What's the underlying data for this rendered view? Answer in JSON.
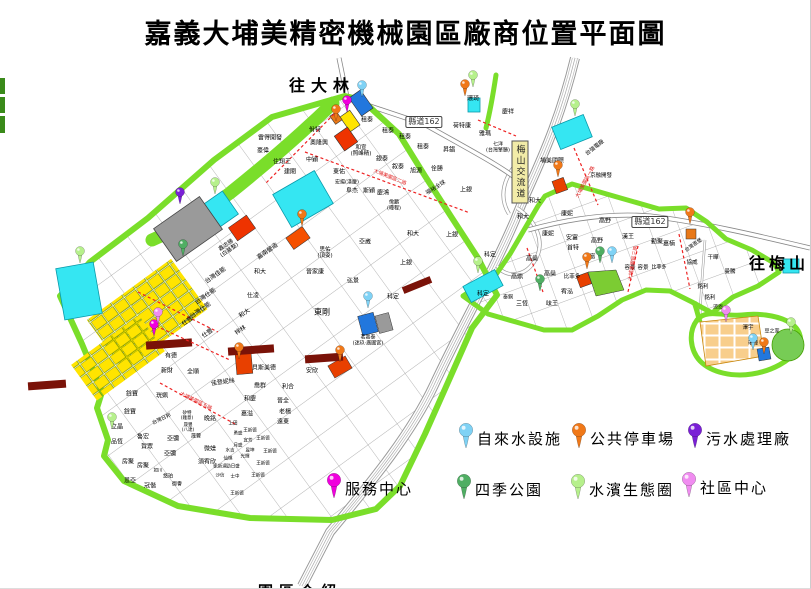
{
  "title": "嘉義大埔美精密機械園區廠商位置平面圖",
  "directions": {
    "to_dalin": {
      "t": "往大林",
      "x": 322,
      "y": 84
    },
    "to_meishan": {
      "t": "往梅山",
      "x": 779,
      "y": 262
    },
    "bottom_partial": {
      "t": "園區介紹",
      "x": 300,
      "y": 591
    }
  },
  "road_badges": [
    {
      "label": "縣道162",
      "x": 424,
      "y": 122
    },
    {
      "label": "縣道162",
      "x": 650,
      "y": 222
    }
  ],
  "interchange": {
    "label": "梅山交流道",
    "x": 520,
    "y": 172
  },
  "road_names": [
    {
      "t": "大埔美園區二路",
      "x": 390,
      "y": 177,
      "r": 22
    },
    {
      "t": "大埔美園區一路",
      "x": 585,
      "y": 182,
      "r": -62
    },
    {
      "t": "大埔美園區三路",
      "x": 633,
      "y": 263,
      "r": -80
    },
    {
      "t": "大埔美園區五路",
      "x": 196,
      "y": 401,
      "r": 26
    }
  ],
  "pin_colors": {
    "waterworks": "#7fd2f5",
    "parking": "#f07818",
    "sewage": "#7a1fd6",
    "service": "#f000dd",
    "park": "#4fae63",
    "eco": "#b6f08c",
    "community": "#f08cf0"
  },
  "legend": {
    "items": [
      {
        "label": "自來水設施",
        "type": "waterworks",
        "x": 466,
        "y": 448
      },
      {
        "label": "公共停車場",
        "type": "parking",
        "x": 579,
        "y": 448
      },
      {
        "label": "污水處理廠",
        "type": "sewage",
        "x": 695,
        "y": 448
      },
      {
        "label": "服務中心",
        "type": "service",
        "x": 334,
        "y": 498
      },
      {
        "label": "四季公園",
        "type": "park",
        "x": 464,
        "y": 499
      },
      {
        "label": "水濱生態圈",
        "type": "eco",
        "x": 578,
        "y": 499
      },
      {
        "label": "社區中心",
        "type": "community",
        "x": 689,
        "y": 497
      }
    ]
  },
  "pins": [
    {
      "type": "waterworks",
      "x": 362,
      "y": 97
    },
    {
      "type": "waterworks",
      "x": 368,
      "y": 308
    },
    {
      "type": "waterworks",
      "x": 612,
      "y": 263
    },
    {
      "type": "waterworks",
      "x": 753,
      "y": 350
    },
    {
      "type": "parking",
      "x": 336,
      "y": 121
    },
    {
      "type": "parking",
      "x": 465,
      "y": 96
    },
    {
      "type": "parking",
      "x": 302,
      "y": 226
    },
    {
      "type": "parking",
      "x": 239,
      "y": 359
    },
    {
      "type": "parking",
      "x": 340,
      "y": 362
    },
    {
      "type": "parking",
      "x": 558,
      "y": 177
    },
    {
      "type": "parking",
      "x": 587,
      "y": 269
    },
    {
      "type": "parking",
      "x": 690,
      "y": 224
    },
    {
      "type": "parking",
      "x": 764,
      "y": 354
    },
    {
      "type": "sewage",
      "x": 180,
      "y": 204
    },
    {
      "type": "service",
      "x": 347,
      "y": 112
    },
    {
      "type": "service",
      "x": 154,
      "y": 336
    },
    {
      "type": "park",
      "x": 183,
      "y": 256
    },
    {
      "type": "park",
      "x": 600,
      "y": 263
    },
    {
      "type": "park",
      "x": 540,
      "y": 291
    },
    {
      "type": "eco",
      "x": 80,
      "y": 263
    },
    {
      "type": "eco",
      "x": 215,
      "y": 194
    },
    {
      "type": "eco",
      "x": 112,
      "y": 429
    },
    {
      "type": "eco",
      "x": 473,
      "y": 87
    },
    {
      "type": "eco",
      "x": 575,
      "y": 116
    },
    {
      "type": "eco",
      "x": 478,
      "y": 273
    },
    {
      "type": "eco",
      "x": 791,
      "y": 334
    },
    {
      "type": "community",
      "x": 158,
      "y": 324
    },
    {
      "type": "community",
      "x": 726,
      "y": 322
    }
  ],
  "plots": [
    {
      "t": "雷得開發",
      "x": 270,
      "y": 139
    },
    {
      "t": "豪偉",
      "x": 263,
      "y": 152
    },
    {
      "t": "住翔王",
      "x": 282,
      "y": 163
    },
    {
      "t": "建閎",
      "x": 290,
      "y": 173
    },
    {
      "t": "佾特",
      "x": 315,
      "y": 131
    },
    {
      "t": "奧隆興",
      "x": 319,
      "y": 144
    },
    {
      "t": "中穎",
      "x": 312,
      "y": 161
    },
    {
      "t": "和宣\n(照峰精)",
      "x": 361,
      "y": 151,
      "s": 5.5
    },
    {
      "t": "東佑",
      "x": 339,
      "y": 173
    },
    {
      "t": "宏揚(漢慶)",
      "x": 347,
      "y": 183,
      "s": 5
    },
    {
      "t": "阜杰",
      "x": 352,
      "y": 192
    },
    {
      "t": "斯穎",
      "x": 369,
      "y": 192
    },
    {
      "t": "慶鴻",
      "x": 383,
      "y": 194
    },
    {
      "t": "佾鵬\n(曄程)",
      "x": 394,
      "y": 206,
      "s": 5
    },
    {
      "t": "租泰",
      "x": 367,
      "y": 121
    },
    {
      "t": "租泰",
      "x": 388,
      "y": 132
    },
    {
      "t": "租泰",
      "x": 405,
      "y": 138
    },
    {
      "t": "租泰",
      "x": 423,
      "y": 148
    },
    {
      "t": "銀泰",
      "x": 382,
      "y": 160
    },
    {
      "t": "叙泰",
      "x": 398,
      "y": 168
    },
    {
      "t": "旭源",
      "x": 416,
      "y": 172
    },
    {
      "t": "佺勝",
      "x": 437,
      "y": 170
    },
    {
      "t": "昇錩",
      "x": 449,
      "y": 151
    },
    {
      "t": "福裕全球",
      "x": 436,
      "y": 188,
      "r": -32,
      "s": 5.5
    },
    {
      "t": "上銀",
      "x": 466,
      "y": 191
    },
    {
      "t": "環琦",
      "x": 473,
      "y": 100
    },
    {
      "t": "慶祥",
      "x": 508,
      "y": 113
    },
    {
      "t": "荷特康",
      "x": 462,
      "y": 127
    },
    {
      "t": "雅瑪",
      "x": 485,
      "y": 135
    },
    {
      "t": "七洋\n(台灣擎勝)",
      "x": 498,
      "y": 148,
      "s": 5
    },
    {
      "t": "埔美國際",
      "x": 552,
      "y": 162
    },
    {
      "t": "台強電廠",
      "x": 595,
      "y": 148,
      "r": -38,
      "s": 5.5
    },
    {
      "t": "京融開發",
      "x": 601,
      "y": 176,
      "s": 5.5
    },
    {
      "t": "鑫志勝\n(白基整)",
      "x": 228,
      "y": 248,
      "r": -35,
      "s": 5.5
    },
    {
      "t": "台灣佳能",
      "x": 216,
      "y": 276,
      "r": -35
    },
    {
      "t": "台灣仕能",
      "x": 206,
      "y": 297,
      "r": -35
    },
    {
      "t": "台灣仕能",
      "x": 201,
      "y": 311,
      "r": -35
    },
    {
      "t": "仕豐",
      "x": 188,
      "y": 322,
      "r": -35
    },
    {
      "t": "仕豐",
      "x": 208,
      "y": 334,
      "r": -35
    },
    {
      "t": "和大",
      "x": 245,
      "y": 314,
      "r": -35
    },
    {
      "t": "梓林",
      "x": 241,
      "y": 331,
      "r": -35
    },
    {
      "t": "嘉南營造",
      "x": 268,
      "y": 252,
      "r": -35
    },
    {
      "t": "和大",
      "x": 260,
      "y": 273
    },
    {
      "t": "仕凌",
      "x": 253,
      "y": 297
    },
    {
      "t": "思佑\n(頂姿)",
      "x": 325,
      "y": 253,
      "s": 5.5
    },
    {
      "t": "晉家康",
      "x": 315,
      "y": 273
    },
    {
      "t": "弘景",
      "x": 353,
      "y": 282
    },
    {
      "t": "亞崴",
      "x": 365,
      "y": 243
    },
    {
      "t": "上銀",
      "x": 452,
      "y": 236
    },
    {
      "t": "上銀",
      "x": 406,
      "y": 264
    },
    {
      "t": "和大",
      "x": 413,
      "y": 235
    },
    {
      "t": "科定",
      "x": 393,
      "y": 298
    },
    {
      "t": "東剛",
      "x": 322,
      "y": 313,
      "s": 8
    },
    {
      "t": "茗嘉泰\n(迷玖·廣圃宮)",
      "x": 368,
      "y": 341,
      "s": 5
    },
    {
      "t": "貝斯美德",
      "x": 264,
      "y": 369
    },
    {
      "t": "安欣",
      "x": 312,
      "y": 372
    },
    {
      "t": "有德",
      "x": 171,
      "y": 357
    },
    {
      "t": "新財",
      "x": 167,
      "y": 372
    },
    {
      "t": "全順",
      "x": 193,
      "y": 373
    },
    {
      "t": "佳登妮絲",
      "x": 223,
      "y": 383,
      "r": -8
    },
    {
      "t": "喬群",
      "x": 260,
      "y": 387
    },
    {
      "t": "利合",
      "x": 288,
      "y": 388
    },
    {
      "t": "和慶",
      "x": 250,
      "y": 400
    },
    {
      "t": "晉全",
      "x": 283,
      "y": 402
    },
    {
      "t": "嘉溢",
      "x": 247,
      "y": 415
    },
    {
      "t": "老楊",
      "x": 285,
      "y": 413
    },
    {
      "t": "遠東",
      "x": 283,
      "y": 423
    },
    {
      "t": "銓寶",
      "x": 132,
      "y": 395
    },
    {
      "t": "銓寶",
      "x": 130,
      "y": 413
    },
    {
      "t": "珖姵",
      "x": 162,
      "y": 397
    },
    {
      "t": "台灣日邦",
      "x": 162,
      "y": 420,
      "r": -25,
      "s": 5
    },
    {
      "t": "矽特\n(雞意)",
      "x": 187,
      "y": 417,
      "s": 4.5
    },
    {
      "t": "晚銘",
      "x": 210,
      "y": 420
    },
    {
      "t": "立晶",
      "x": 117,
      "y": 428
    },
    {
      "t": "晟豐\n(八達)",
      "x": 188,
      "y": 429,
      "s": 4.5
    },
    {
      "t": "晟豐",
      "x": 196,
      "y": 437,
      "s": 5
    },
    {
      "t": "品恆",
      "x": 117,
      "y": 443
    },
    {
      "t": "魯宏",
      "x": 143,
      "y": 438
    },
    {
      "t": "賀眾",
      "x": 147,
      "y": 448
    },
    {
      "t": "亞彌",
      "x": 173,
      "y": 440
    },
    {
      "t": "亞彌",
      "x": 170,
      "y": 455
    },
    {
      "t": "微媄",
      "x": 210,
      "y": 450
    },
    {
      "t": "房聚",
      "x": 128,
      "y": 463
    },
    {
      "t": "房聚",
      "x": 143,
      "y": 467
    },
    {
      "t": "須宥欣",
      "x": 207,
      "y": 463
    },
    {
      "t": "如川",
      "x": 158,
      "y": 472,
      "s": 4.5
    },
    {
      "t": "悠珀",
      "x": 168,
      "y": 477,
      "s": 5
    },
    {
      "t": "恩亞",
      "x": 130,
      "y": 482
    },
    {
      "t": "冠偕",
      "x": 150,
      "y": 487
    },
    {
      "t": "御譽",
      "x": 177,
      "y": 485,
      "s": 5
    },
    {
      "t": "上田",
      "x": 233,
      "y": 425,
      "s": 4.5
    },
    {
      "t": "勇盛",
      "x": 238,
      "y": 435,
      "s": 4.5
    },
    {
      "t": "王新德",
      "x": 250,
      "y": 432,
      "s": 4.5
    },
    {
      "t": "宜芳",
      "x": 248,
      "y": 442,
      "s": 4.5
    },
    {
      "t": "月盛",
      "x": 238,
      "y": 447,
      "s": 4.5
    },
    {
      "t": "昱坤",
      "x": 250,
      "y": 452,
      "s": 4.5
    },
    {
      "t": "水吉",
      "x": 230,
      "y": 452,
      "s": 4.5
    },
    {
      "t": "光輝",
      "x": 245,
      "y": 458,
      "s": 4.5
    },
    {
      "t": "仙棋",
      "x": 228,
      "y": 460,
      "s": 4.5
    },
    {
      "t": "勁日盛",
      "x": 233,
      "y": 468,
      "s": 4.5
    },
    {
      "t": "凱新達",
      "x": 220,
      "y": 468,
      "s": 4.5
    },
    {
      "t": "沙信",
      "x": 220,
      "y": 477,
      "s": 4.5
    },
    {
      "t": "士中",
      "x": 235,
      "y": 478,
      "s": 4.5
    },
    {
      "t": "王新德",
      "x": 263,
      "y": 440,
      "s": 4.5
    },
    {
      "t": "王新德",
      "x": 270,
      "y": 453,
      "s": 4.5
    },
    {
      "t": "王新德",
      "x": 263,
      "y": 465,
      "s": 4.5
    },
    {
      "t": "王新德",
      "x": 258,
      "y": 477,
      "s": 4.5
    },
    {
      "t": "王新德",
      "x": 237,
      "y": 495,
      "s": 4.5
    },
    {
      "t": "和大",
      "x": 535,
      "y": 202
    },
    {
      "t": "和大",
      "x": 523,
      "y": 218
    },
    {
      "t": "康妮",
      "x": 567,
      "y": 215
    },
    {
      "t": "康妮",
      "x": 548,
      "y": 235
    },
    {
      "t": "安富",
      "x": 572,
      "y": 239
    },
    {
      "t": "首特",
      "x": 573,
      "y": 249
    },
    {
      "t": "高野",
      "x": 605,
      "y": 222
    },
    {
      "t": "高野",
      "x": 597,
      "y": 242
    },
    {
      "t": "漢王",
      "x": 628,
      "y": 238
    },
    {
      "t": "勤聚",
      "x": 657,
      "y": 243
    },
    {
      "t": "嘉楠",
      "x": 669,
      "y": 245
    },
    {
      "t": "台灣恩堡",
      "x": 694,
      "y": 246,
      "r": -35,
      "s": 5
    },
    {
      "t": "容景",
      "x": 630,
      "y": 268,
      "s": 5.5
    },
    {
      "t": "容景",
      "x": 643,
      "y": 268,
      "s": 5.5
    },
    {
      "t": "比菲多",
      "x": 659,
      "y": 268,
      "s": 5
    },
    {
      "t": "比菲多",
      "x": 572,
      "y": 277,
      "s": 5.5
    },
    {
      "t": "協威",
      "x": 692,
      "y": 263,
      "s": 5.5
    },
    {
      "t": "干曄",
      "x": 713,
      "y": 258,
      "s": 5.5
    },
    {
      "t": "曼騰",
      "x": 730,
      "y": 272,
      "s": 5.5
    },
    {
      "t": "銘利",
      "x": 703,
      "y": 287,
      "s": 5.5
    },
    {
      "t": "銘利",
      "x": 710,
      "y": 298,
      "s": 5.5
    },
    {
      "t": "涼恩",
      "x": 718,
      "y": 308,
      "s": 5
    },
    {
      "t": "澤宇",
      "x": 748,
      "y": 328,
      "s": 5.5
    },
    {
      "t": "瑞曄",
      "x": 753,
      "y": 344,
      "s": 5
    },
    {
      "t": "豆之家",
      "x": 772,
      "y": 332,
      "s": 5
    },
    {
      "t": "高鼎",
      "x": 517,
      "y": 278
    },
    {
      "t": "高燊",
      "x": 532,
      "y": 260
    },
    {
      "t": "高燊",
      "x": 550,
      "y": 275
    },
    {
      "t": "旦富",
      "x": 590,
      "y": 257,
      "s": 5.5
    },
    {
      "t": "宥泓",
      "x": 567,
      "y": 293
    },
    {
      "t": "味王",
      "x": 552,
      "y": 305
    },
    {
      "t": "三恆",
      "x": 522,
      "y": 305
    },
    {
      "t": "泰銅",
      "x": 508,
      "y": 298,
      "s": 5
    },
    {
      "t": "科定",
      "x": 490,
      "y": 256
    },
    {
      "t": "科定",
      "x": 483,
      "y": 295
    }
  ],
  "palette": {
    "boundary": "#7ade2a",
    "water": "#35e6f2",
    "lot_yellow": "#ffe400",
    "plant_gray": "#9a9a9a",
    "block_blue": "#2277dd",
    "block_red": "#ee3300",
    "block_orange": "#e87818",
    "bar_maroon": "#7a1208",
    "road_dash": "#ee2222",
    "cluster_tan": "#f8ce8c"
  }
}
